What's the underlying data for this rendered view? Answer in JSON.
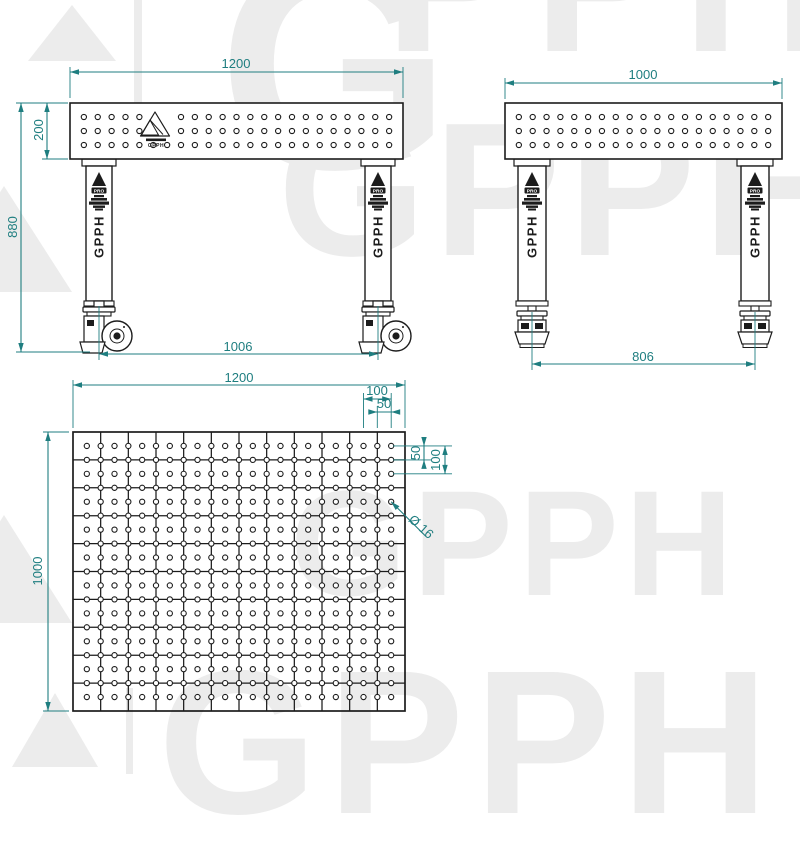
{
  "colors": {
    "ink": "#1c1c1c",
    "dim": "#1f7e80",
    "watermark": "#ececec"
  },
  "logo": {
    "brand": "GPPH",
    "sub": "PRO"
  },
  "watermark": {
    "rows": [
      {
        "text": "G"
      },
      {
        "text": "PPH"
      },
      {
        "text": "GPPH"
      },
      {
        "text": "GPPH"
      },
      {
        "text": "GPPH"
      }
    ]
  },
  "views": {
    "front": {
      "dims": {
        "width": "1200",
        "plate_height": "200",
        "total_height": "880",
        "wheel_span": "1006"
      }
    },
    "side": {
      "dims": {
        "width": "1000",
        "foot_span": "806"
      }
    },
    "plan": {
      "dims": {
        "width": "1200",
        "depth": "1000",
        "line_pitch": "100",
        "edge_offset": "50",
        "hole_row_offset": "50",
        "hole_row_pitch": "100",
        "hole_diameter": "Ø 16"
      },
      "grid": {
        "cols": 12,
        "rows": 10,
        "hole_cols": 23,
        "hole_rows": 19,
        "hole_pitch_mm": 50,
        "line_pitch_mm": 100
      }
    }
  }
}
